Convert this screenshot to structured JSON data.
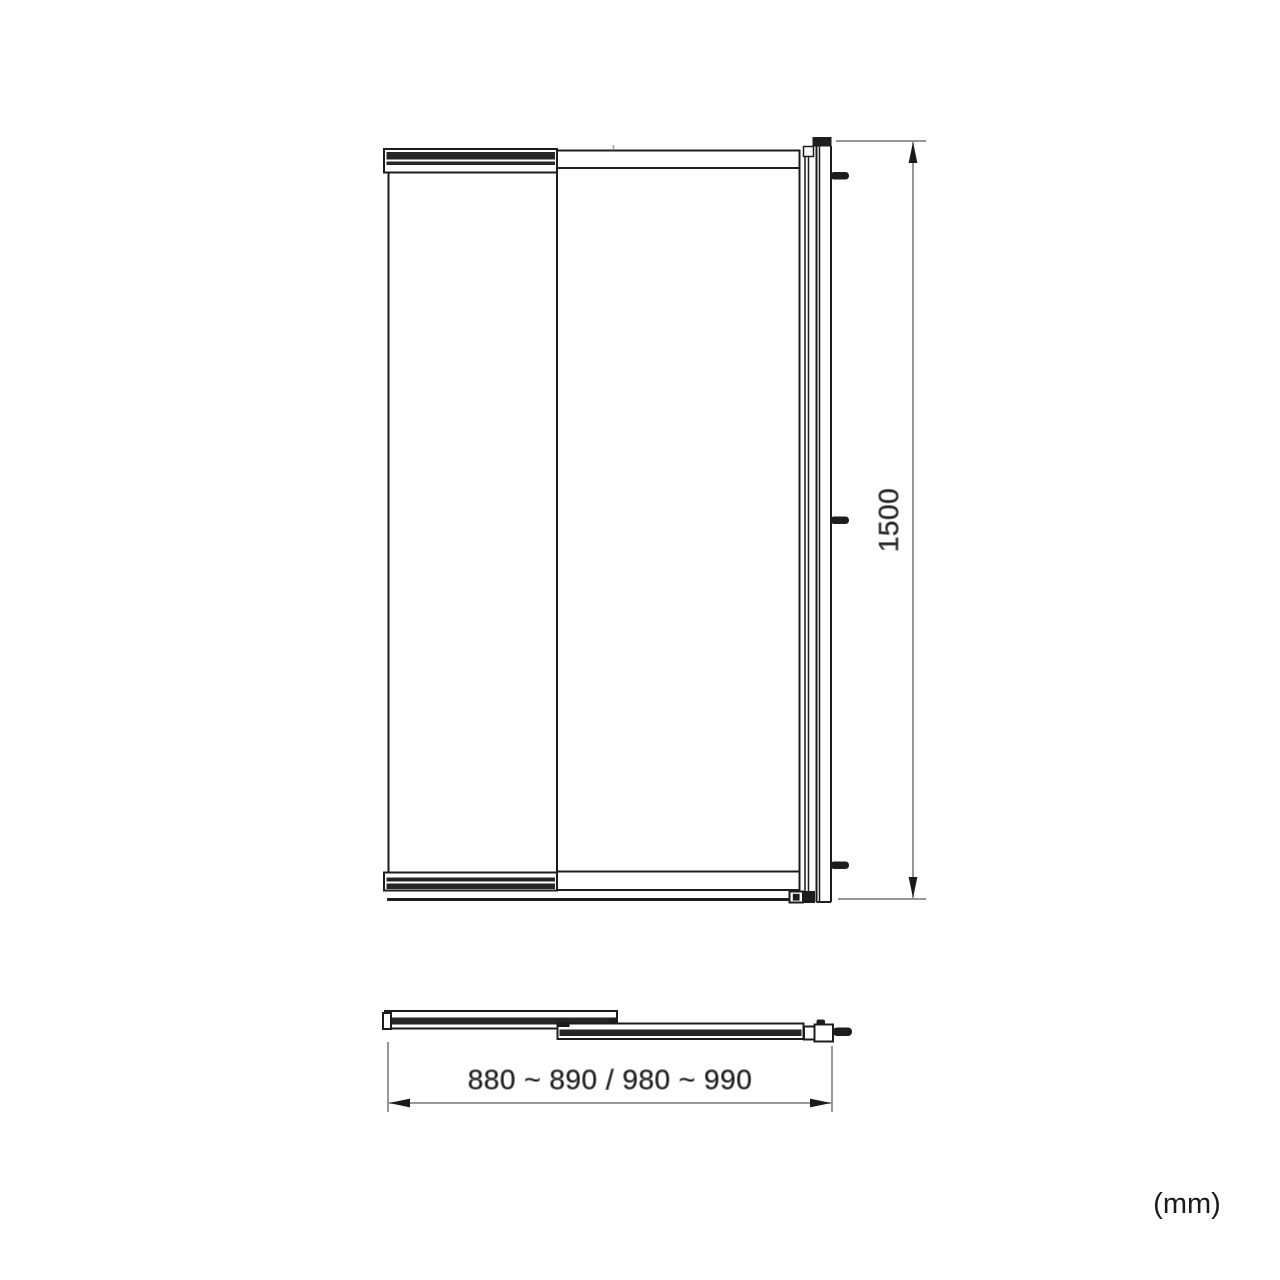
{
  "dimensions": {
    "height": "1500",
    "width_range": "880 ~ 890 / 980 ~ 990",
    "units": "(mm)"
  },
  "colors": {
    "line": "#1d1d1d",
    "dark_fill": "#262626",
    "dimension_line": "#757575",
    "text": "#1a1a1a",
    "background": "#ffffff"
  }
}
